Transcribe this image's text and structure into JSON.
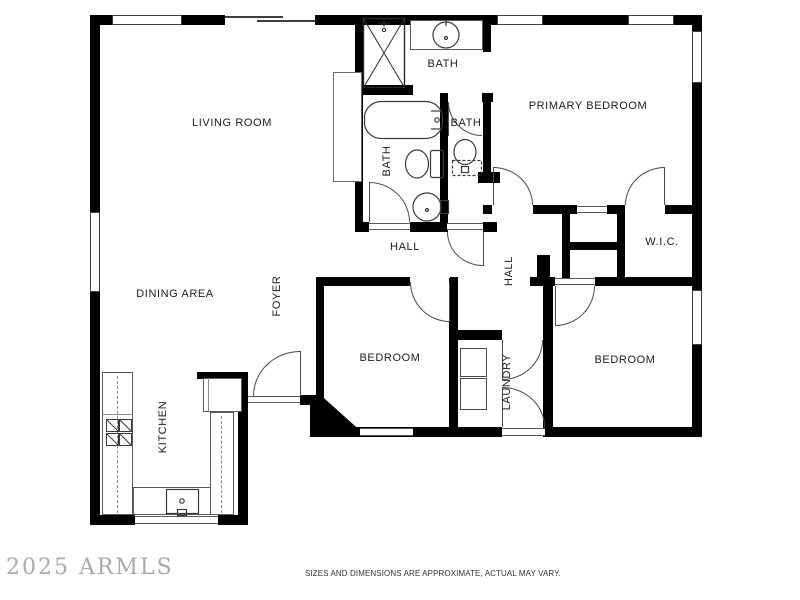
{
  "labels": {
    "living_room": "LIVING ROOM",
    "dining_area": "DINING AREA",
    "kitchen": "KITCHEN",
    "foyer": "FOYER",
    "bath_top": "BATH",
    "bath_hall": "BATH",
    "bath_ensuite": "BATH",
    "hall_main": "HALL",
    "hall_bedroom": "HALL",
    "primary_bedroom": "PRIMARY BEDROOM",
    "wic": "W.I.C.",
    "bedroom_left": "BEDROOM",
    "bedroom_right": "BEDROOM",
    "laundry": "LAUNDRY"
  },
  "watermark": "2025 ARMLS",
  "disclaimer": "SIZES AND DIMENSIONS ARE APPROXIMATE, ACTUAL MAY VARY.",
  "colors": {
    "wall": "#000000",
    "line": "#4a4a4a",
    "background": "#ffffff",
    "label": "#1c1c1c",
    "watermark": "#9b9b9b",
    "disclaimer": "#333333"
  }
}
